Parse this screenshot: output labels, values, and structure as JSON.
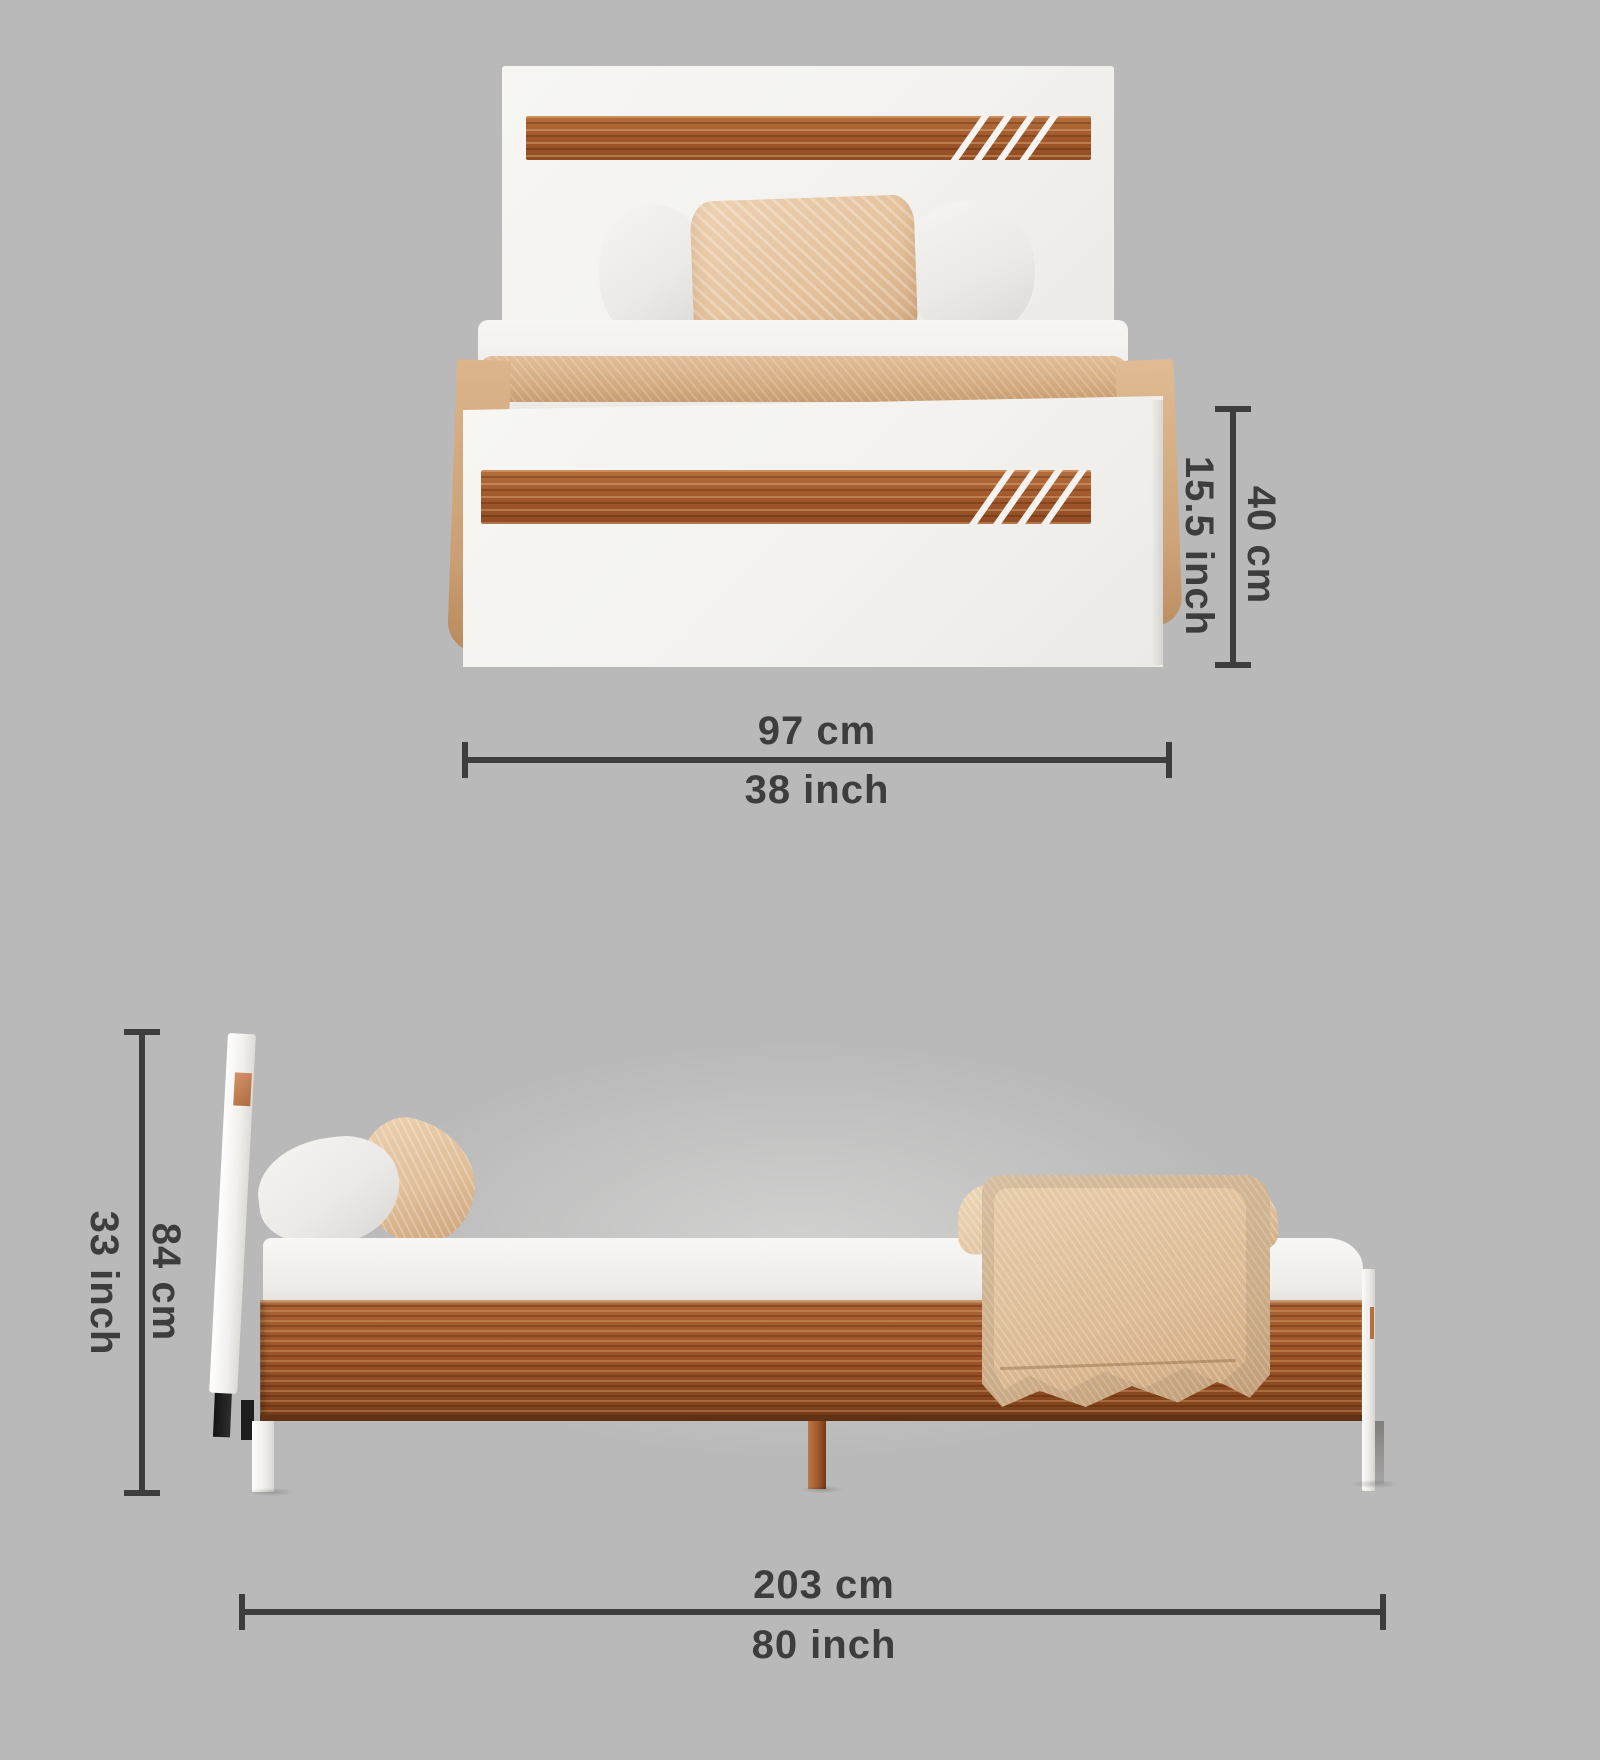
{
  "title": "Bed dimension diagram with front and side views",
  "colors": {
    "background": "#b9b9b9",
    "annotation": "#3d3d3d",
    "wood": "#a05a2c",
    "panel_white": "#f4f3f0",
    "fabric_beige": "#dcba92"
  },
  "views": {
    "front": {
      "height": {
        "cm": "40 cm",
        "inch": "15.5 inch"
      },
      "width": {
        "cm": "97 cm",
        "inch": "38 inch"
      }
    },
    "side": {
      "height": {
        "cm": "84 cm",
        "inch": "33 inch"
      },
      "length": {
        "cm": "203 cm",
        "inch": "80 inch"
      }
    }
  }
}
